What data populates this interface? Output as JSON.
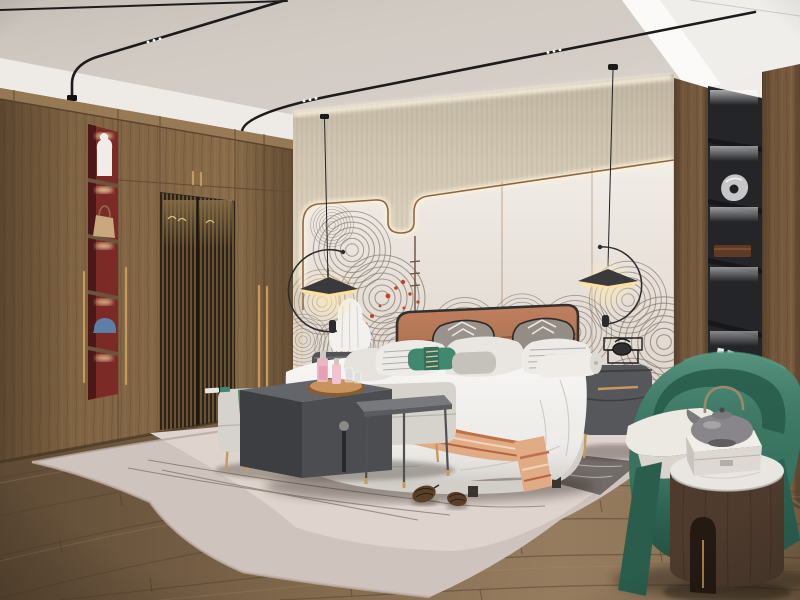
{
  "scene": {
    "title": "Modern wood-tone bedroom interior render",
    "style": "contemporary new-Chinese bedroom",
    "lighting": [
      "black ceiling track lights with led dots",
      "cove lighting above feature wall",
      "two arc pendant lamps",
      "lit wardrobe niche",
      "lit black shelf column"
    ]
  },
  "palette": {
    "ceiling_white": "#f3f1ee",
    "ceiling_panel": "#d3ccc5",
    "rail_black": "#1c1c1c",
    "wall_beige": "#d9cebb",
    "wall_cream": "#eae3db",
    "wall_trim": "#8c6848",
    "swirl_gray": "#857a6f",
    "accent_red": "#bf4326",
    "wardrobe_wood": "#8a6c49",
    "niche_red": "#7c2a26",
    "lattice_dark": "#2c2318",
    "brass": "#c59a5f",
    "column_wood": "#7a5c40",
    "shelf_black": "#232528",
    "floor_wood": "#8a7053",
    "floor_line": "#54432f",
    "rug": "#cfc3bd",
    "rug_inner": "#ded4cd",
    "rug_line": "#5f554b",
    "bedding": "#efedea",
    "bed_platform": "#d2cec8",
    "headboard_leather": "#a8613f",
    "headboard_frame": "#33302d",
    "pillow_gray": "#9a938c",
    "throw_salmon": "#e0ac85",
    "stripe_terracotta": "#c0714b",
    "teal": "#42876f",
    "bench": "#d6d2cc",
    "table_dark": "#4b4d50",
    "metal_table": "#77797c",
    "nightstand": "#55575b",
    "ceramic_white": "#f3f1ee",
    "chair_green": "#3a7b66",
    "chair_dark": "#2a5d4c",
    "round_table_wood": "#4e3b2e",
    "marble": "#e9e6e1",
    "teapot_gray": "#88868a",
    "pinecone": "#5a4028"
  },
  "objects": {
    "ceiling": "recessed ceiling with black magnetic track lights",
    "wardrobe": "wood wardrobe with lattice doors, long brass handles and lit display niche",
    "wardrobe_niche_items": [
      "white vase",
      "tan handbag",
      "blue cap"
    ],
    "feature_wall": "cream panel wall with wave line-art mural and red blossoms",
    "bed": "upholstered platform bed with terracotta leather headboard",
    "pillows": [
      "gray chevron pillows",
      "white pillows",
      "striped pillows",
      "teal lumbar pillow",
      "bolster"
    ],
    "throw": "white runner with terracotta stripes",
    "bench": "upholstered bench with teal throw",
    "side_tables": [
      "dark waterfall side table",
      "gray metal side table",
      "round wood drum table with marble top"
    ],
    "nightstands": [
      "left nightstand with white ceramic lamp",
      "right gray nightstand with wire decor and brass legs"
    ],
    "shelf_column": "black back-lit shelf niche with silver sculpture, wooden box and books",
    "armchair": "green barrel armchair with white seat cushion",
    "rug": "light two-tone area rug with thin line pattern and two pinecones",
    "floor": "wide-plank oak floor",
    "decor": [
      "pink perfume bottles on round wood tray",
      "gray clay teapot",
      "white marble box"
    ]
  }
}
